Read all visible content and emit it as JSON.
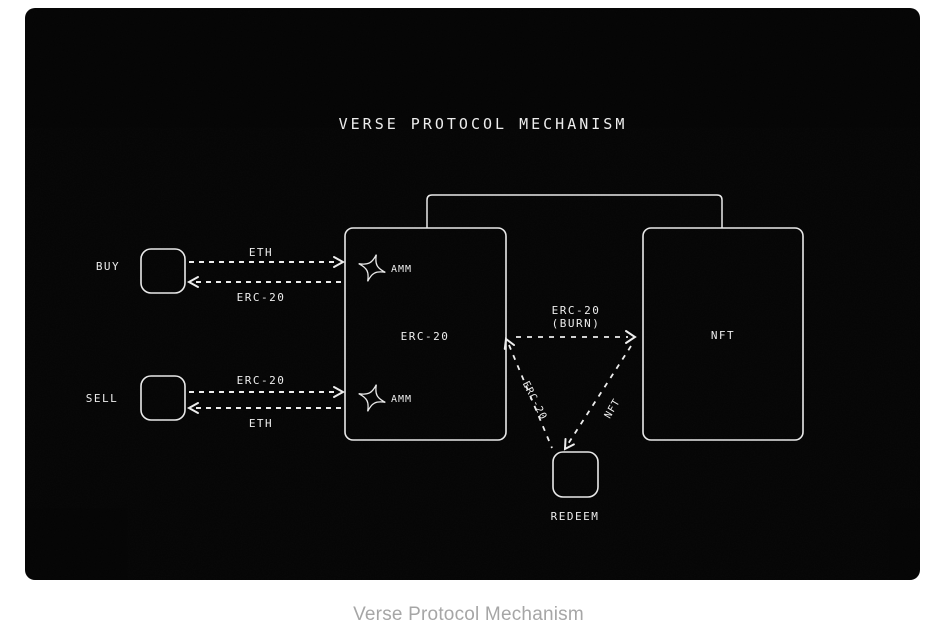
{
  "figure": {
    "title": "VERSE PROTOCOL MECHANISM",
    "caption": "Verse Protocol Mechanism"
  },
  "nodes": {
    "buy": {
      "label": "BUY"
    },
    "sell": {
      "label": "SELL"
    },
    "erc20": {
      "label": "ERC-20"
    },
    "nft": {
      "label": "NFT"
    },
    "redeem": {
      "label": "REDEEM"
    },
    "amm_top": {
      "label": "AMM"
    },
    "amm_bottom": {
      "label": "AMM"
    }
  },
  "edges": {
    "buy_in": {
      "label": "ETH"
    },
    "buy_out": {
      "label": "ERC-20"
    },
    "sell_in": {
      "label": "ERC-20"
    },
    "sell_out": {
      "label": "ETH"
    },
    "burn_line1": {
      "label": "ERC-20"
    },
    "burn_line2": {
      "label": "(BURN)"
    },
    "redeem_erc20": {
      "label": "ERC-20"
    },
    "redeem_nft": {
      "label": "NFT"
    }
  },
  "colors": {
    "page_bg": "#ffffff",
    "canvas_bg": "#050505",
    "line": "#ededed",
    "caption_text": "#a6a6a6"
  }
}
